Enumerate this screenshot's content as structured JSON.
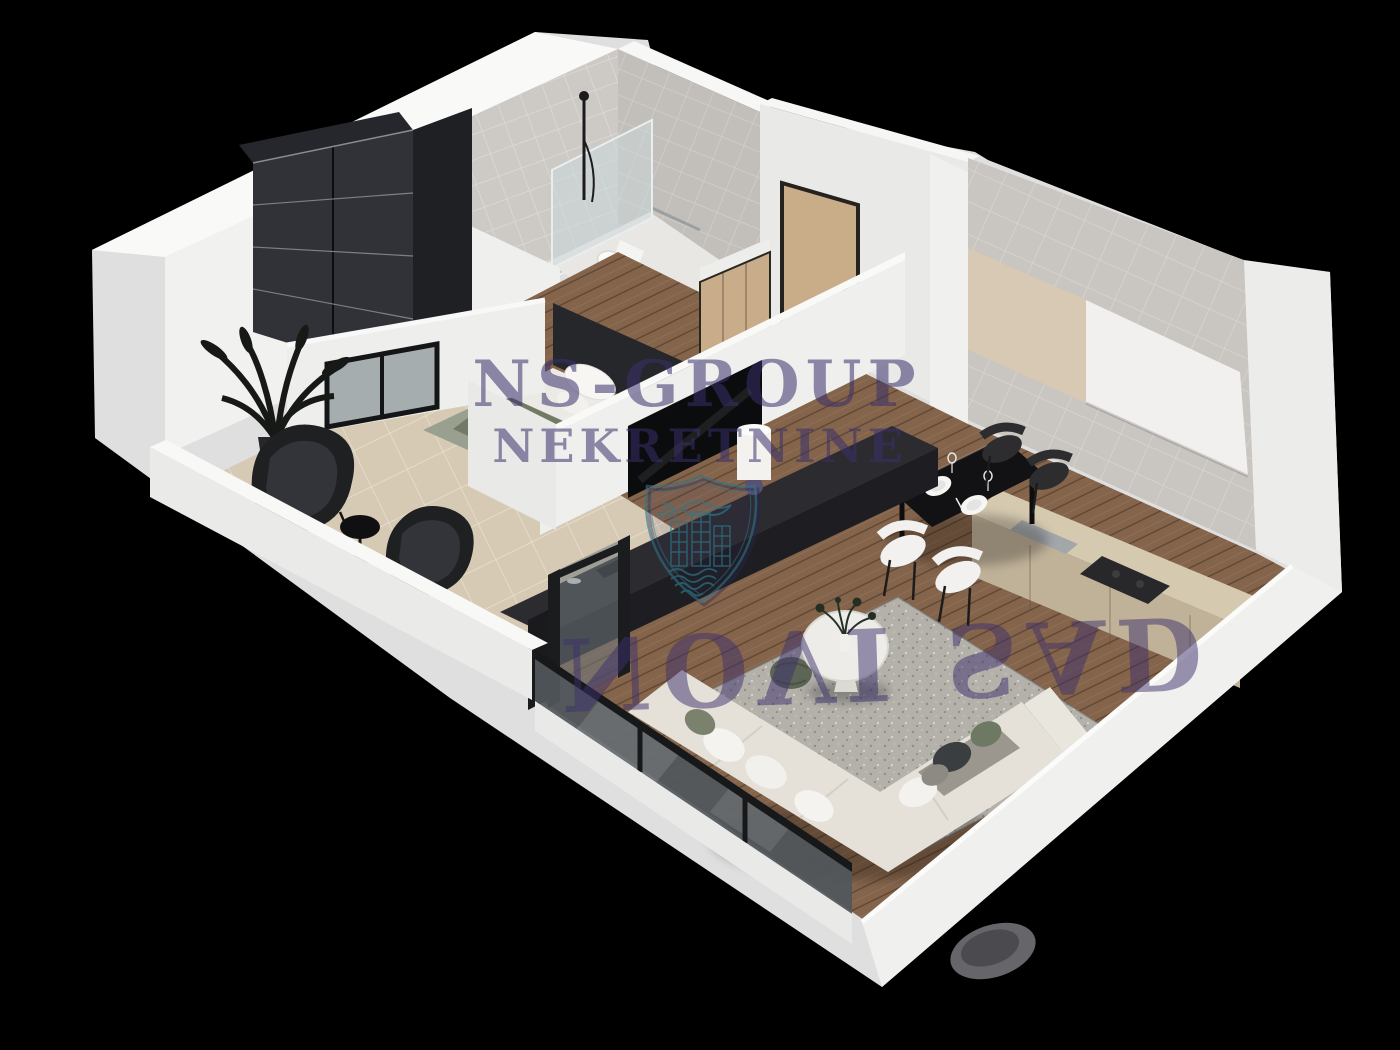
{
  "scene": {
    "title": "3D apartment floor plan render",
    "background_color": "#000000"
  },
  "watermark": {
    "line1": "NS-GROUP",
    "line2": "NEKRETNINE",
    "line3": "NOVI SAD",
    "text_color": "#3b2f6b",
    "logo": "shield-dove-buildings-waves-icon",
    "logo_primary_color": "#2f7486",
    "logo_secondary_color": "#2a2550"
  },
  "palette": {
    "wall_white": "#f0f0ef",
    "wall_shadow": "#dfdfdf",
    "tile_gray": "#cac7c3",
    "floor_wood": "#84644b",
    "floor_balcony": "#d7cab4",
    "furniture_dark": "#2b2b30",
    "sofa_cream": "#e5e1d9",
    "accent_sage": "#6e7963"
  },
  "rooms": [
    {
      "name": "bedroom",
      "items": [
        "wardrobe",
        "double-bed",
        "window-to-balcony"
      ]
    },
    {
      "name": "bathroom",
      "items": [
        "walk-in-shower",
        "toilet"
      ]
    },
    {
      "name": "entry-hall",
      "items": [
        "entry-door",
        "closet"
      ]
    },
    {
      "name": "kitchen",
      "items": [
        "upper-cabinets",
        "counter",
        "cooktop",
        "dining-table",
        "chairs"
      ]
    },
    {
      "name": "living-room",
      "items": [
        "tv-wall",
        "console",
        "corner-sofa",
        "coffee-table",
        "rug",
        "pouf"
      ]
    },
    {
      "name": "balcony",
      "items": [
        "lounge-chairs",
        "side-table",
        "plant"
      ]
    }
  ]
}
